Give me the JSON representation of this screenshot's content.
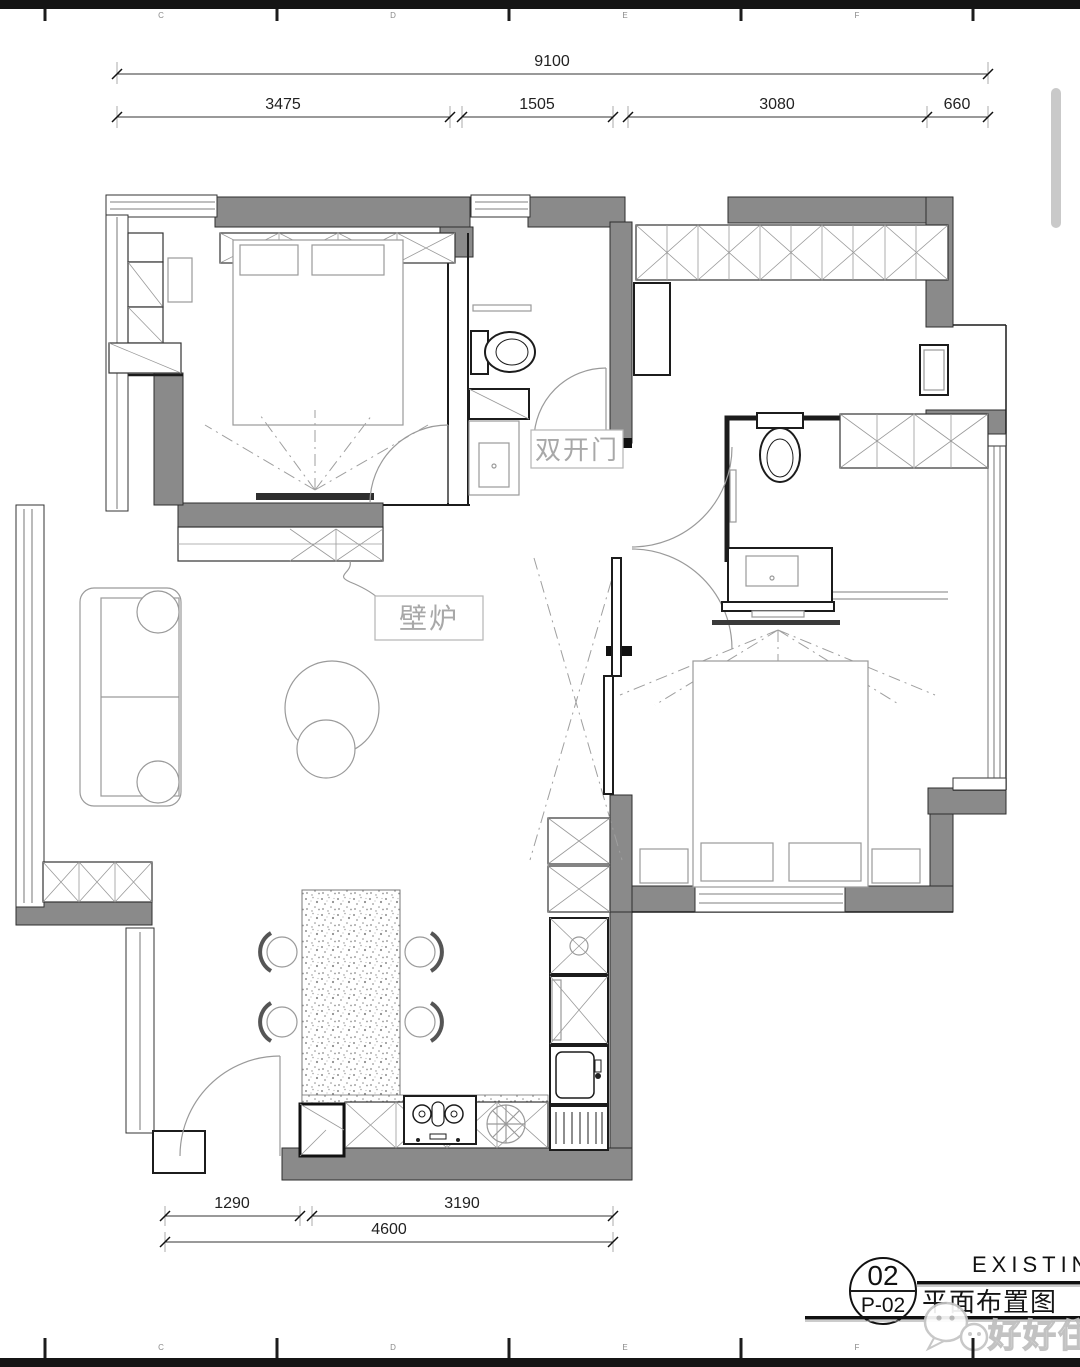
{
  "grid_letters": [
    "C",
    "D",
    "E",
    "F"
  ],
  "dimensions": {
    "top_overall": "9100",
    "top_segments": [
      "3475",
      "1505",
      "3080",
      "660"
    ],
    "bottom_segments": [
      "1290",
      "3190"
    ],
    "bottom_overall": "4600"
  },
  "annotations": {
    "double_door": "双开门",
    "fireplace": "壁炉"
  },
  "title_block": {
    "sheet_number": "02",
    "sheet_code": "P-02",
    "drawing_title": "平面布置图",
    "header_text": "EXISTIN"
  },
  "watermark_text": "好好住",
  "colors": {
    "wall": "#8a8a8a",
    "line": "#1c1c1c",
    "furniture": "#9a9a9a",
    "annotation": "#a8a8a8",
    "watermark": "#c4c4c4",
    "scrollbar": "#c9c9c9"
  }
}
